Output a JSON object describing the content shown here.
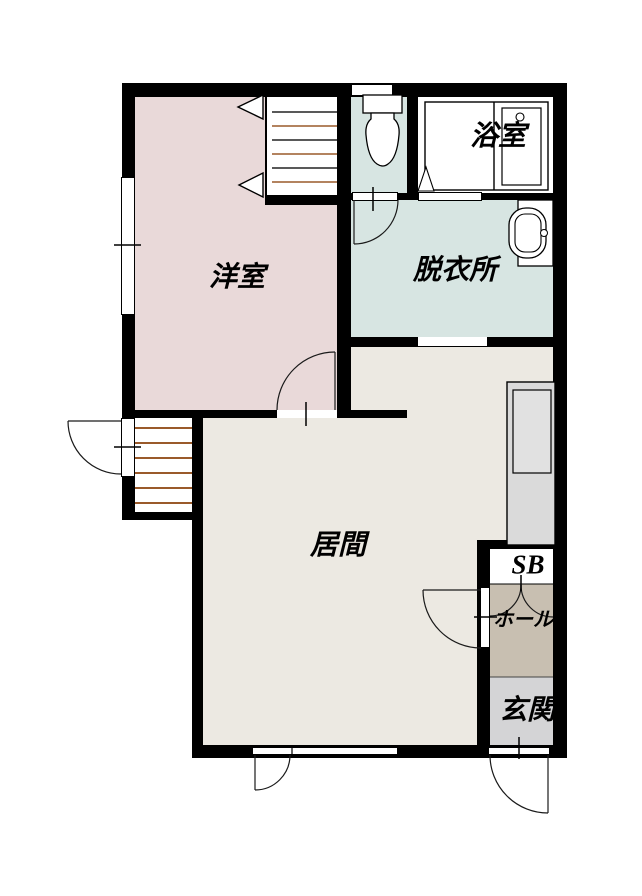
{
  "plan": {
    "title": "apartment-floor-plan",
    "rooms": {
      "yoshitsu": {
        "label": "洋室",
        "color": "#e9d9d9"
      },
      "bath": {
        "label": "浴室",
        "color": "#ffffff"
      },
      "toilet": {
        "label": "",
        "color": "#d7e5e2"
      },
      "datsuijo": {
        "label": "脱衣所",
        "color": "#d7e5e2"
      },
      "ima": {
        "label": "居間",
        "color": "#ece9e2"
      },
      "sb": {
        "label": "SB",
        "color": "#ffffff"
      },
      "hall": {
        "label": "ホール",
        "color": "#c8bfb1"
      },
      "genkan": {
        "label": "玄関",
        "color": "#d4d4d6"
      }
    },
    "palette": {
      "wall": "#000000",
      "stair_line": "#9a5a2a",
      "kitchen_unit": "#dadada",
      "kitchen_unit_inner": "#e1e1e1",
      "background": "#ffffff",
      "label_text": "#000000"
    }
  }
}
